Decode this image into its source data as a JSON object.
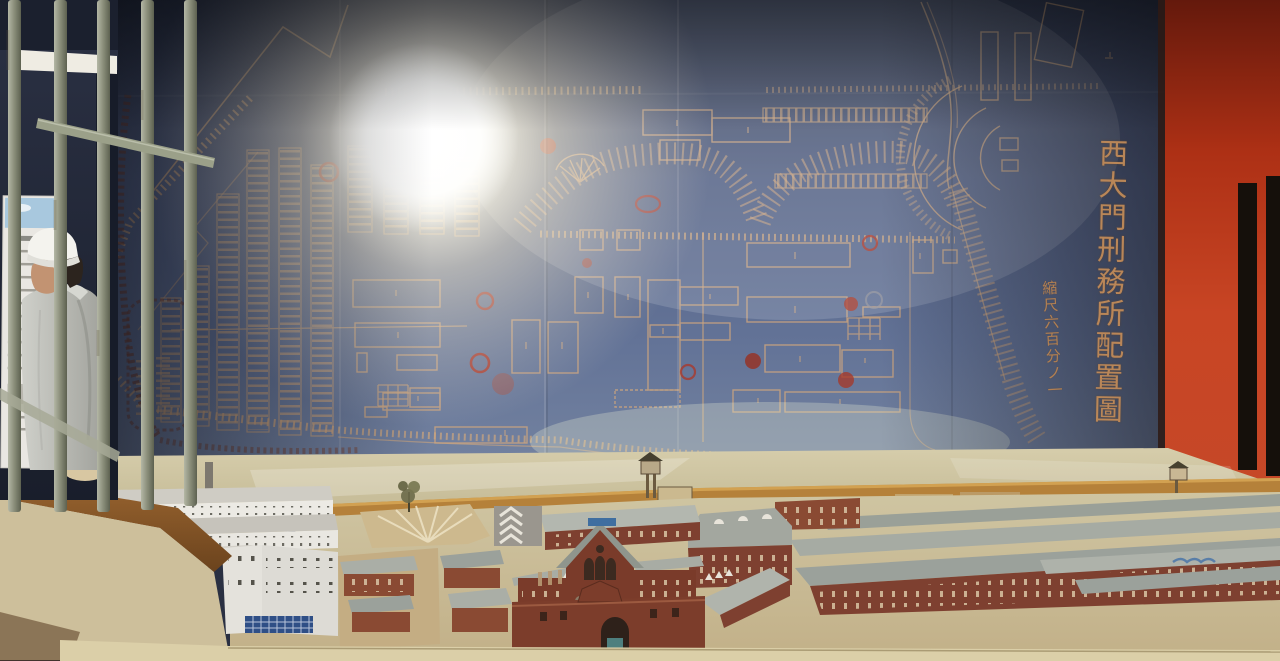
{
  "scene": {
    "map": {
      "title_vertical": "西大門刑務所配置圖",
      "scale_note": "縮尺六百分ノ一"
    },
    "colors": {
      "map_background": "#4d5b7d",
      "map_linework": "#cfa67e",
      "stamp_red": "#ad3526",
      "title_tan": "#c08a58",
      "right_wall_red": "#c13d1f",
      "hill_tan": "#c9bf9c",
      "rear_wall_ochre": "#b5813a",
      "brick_red": "#7e3b28",
      "roof_gray": "#9ba19b",
      "white_building": "#eceae4",
      "bars_metal": "#8f9383"
    }
  }
}
